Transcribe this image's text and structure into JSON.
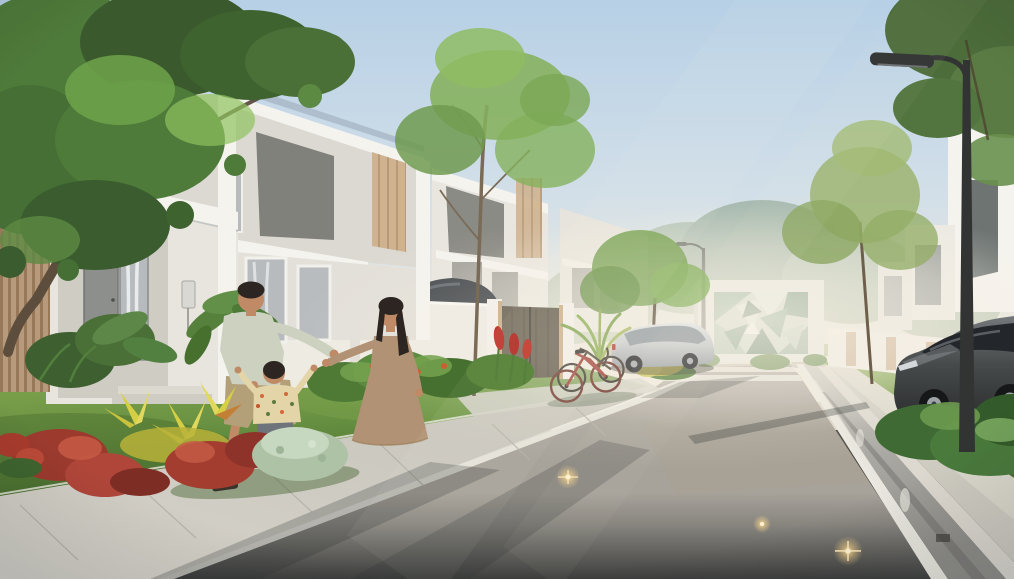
{
  "scene": {
    "setting": "Photorealistic rendering of a modern suburban townhouse street at hazy sunrise with a family of three playing on the front lawn",
    "objects": [
      "two-story-white-townhouse-row",
      "wood-slat-facade-panel",
      "front-door-with-glass-sidelight",
      "family-father-mother-child-on-lawn",
      "tropical-garden-beds",
      "large-shade-tree",
      "slender-street-trees",
      "white-privacy-wall-and-bronze-gate",
      "two-parked-bicycles",
      "silver-parked-car",
      "charcoal-parked-suv",
      "green-geometric-mural-wall",
      "street-lamp",
      "asphalt-road-with-embedded-stud-lights",
      "concrete-sidewalk-and-curb",
      "crosswalk-stripes",
      "wet-drainage-channel"
    ]
  },
  "colors": {
    "sky_top": "#b7d0e6",
    "sky_mid": "#d2dfe8",
    "sky_horizon": "#ece8dc",
    "house_white": "#f5f3ee",
    "house_shade": "#dcd9d2",
    "house_grey_panel": "#81817b",
    "wood_tone": "#b69a7b",
    "wood_dark": "#97795a",
    "roof_blue": "#a7b7c6",
    "door_grey": "#8d8f8c",
    "glass_tone": "#b7bbbe",
    "grass_light": "#8cae54",
    "grass_mid": "#6b9343",
    "grass_dark": "#4a7231",
    "foliage_dark": "#3c5c30",
    "foliage_mid": "#5d8443",
    "foliage_light": "#85b15c",
    "croton_yellow": "#d6cf45",
    "plant_red": "#a23d2f",
    "bush_silver": "#aec2a6",
    "road_far": "#a7a29a",
    "road_near": "#3e3f3e",
    "sidewalk": "#d6d3ca",
    "line_white": "#eae8df",
    "gutter_dark": "#56534c",
    "mural_green": "#8fae97",
    "mural_green_dark": "#5f8069",
    "mural_pale": "#dfe8df",
    "lamp_dark": "#323433",
    "car_dark": "#474a4b",
    "car_silver": "#c7cacc",
    "skin": "#c08a66",
    "hair_dark": "#2c2521",
    "shirt_sage": "#ccd1c0",
    "shorts_khaki": "#b3a078",
    "dress_tan": "#b29274",
    "child_shirt": "#e4d5a8",
    "child_shorts": "#6f747b",
    "stud_glow": "#ffd98a",
    "stud_core": "#fff3d3"
  }
}
